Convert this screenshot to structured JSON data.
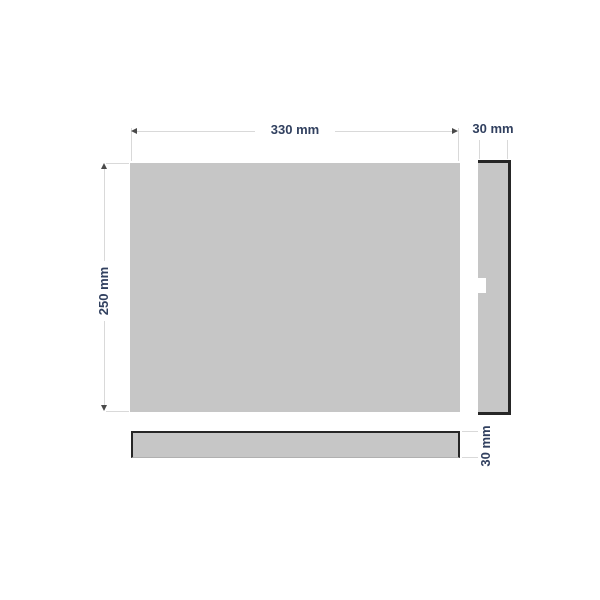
{
  "views": {
    "front": {
      "width_label": "330 mm",
      "height_label": "250 mm"
    },
    "side": {
      "thickness_label": "30 mm"
    },
    "top": {
      "thickness_label": "30 mm"
    }
  },
  "colors": {
    "panel_fill": "#c6c6c6",
    "edge_stroke": "#262626",
    "dimension_line": "#d9d9d9",
    "arrow": "#4a4a4a",
    "label_text": "#31405f",
    "background": "#ffffff"
  }
}
